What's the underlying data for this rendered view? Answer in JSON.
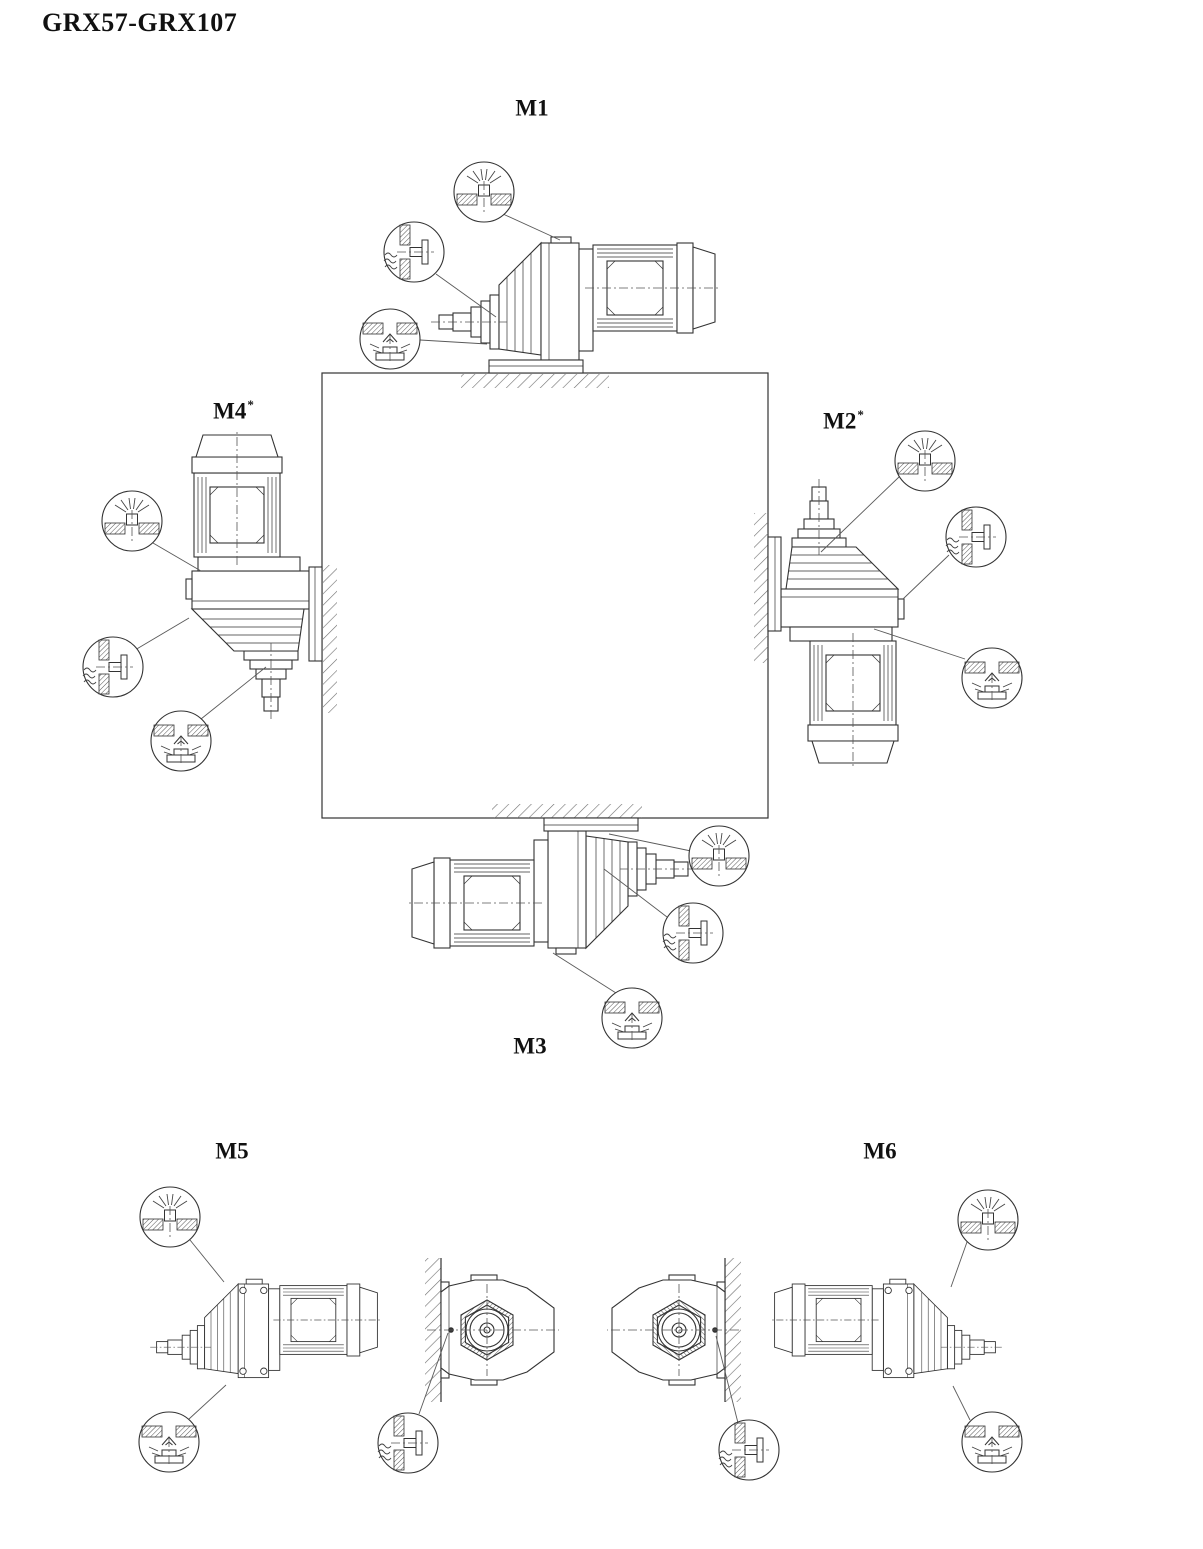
{
  "title": "GRX57-GRX107",
  "diagram": {
    "type": "gearmotor-mounting-positions",
    "positions": [
      {
        "label": "M1",
        "sup": "",
        "mounting": "floor",
        "plugs": [
          "breather",
          "oil-level",
          "oil-drain"
        ]
      },
      {
        "label": "M2",
        "sup": "*",
        "mounting": "wall-right",
        "plugs": [
          "breather",
          "oil-level",
          "oil-drain"
        ]
      },
      {
        "label": "M3",
        "sup": "",
        "mounting": "ceiling",
        "plugs": [
          "breather",
          "oil-level",
          "oil-drain"
        ]
      },
      {
        "label": "M4",
        "sup": "*",
        "mounting": "wall-left",
        "plugs": [
          "breather",
          "oil-level",
          "oil-drain"
        ]
      },
      {
        "label": "M5",
        "sup": "",
        "mounting": "wall-shaft-horizontal",
        "plugs": [
          "breather",
          "oil-drain",
          "oil-level"
        ]
      },
      {
        "label": "M6",
        "sup": "",
        "mounting": "wall-shaft-horizontal",
        "plugs": [
          "breather",
          "oil-drain",
          "oil-level"
        ]
      }
    ],
    "icons": {
      "breather": "breather-plug-icon",
      "oil_level": "oil-level-plug-icon",
      "oil_drain": "oil-drain-plug-icon"
    },
    "colors": {
      "line": "#333333",
      "leader": "#5a5a5a",
      "hatch": "#6e6e6e",
      "background": "#ffffff",
      "text": "#111111"
    }
  }
}
